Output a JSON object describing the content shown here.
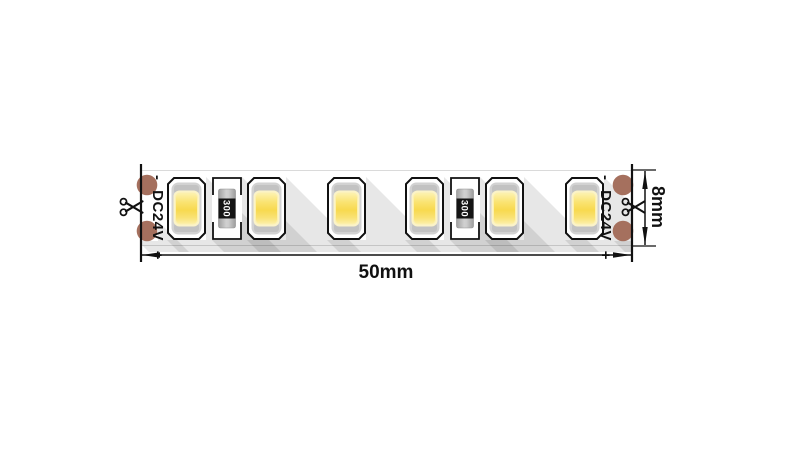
{
  "diagram": {
    "description": "LED strip segment dimension drawing",
    "power_marking": {
      "negative": "-",
      "label": "DC24V",
      "positive": "+"
    },
    "resistor": {
      "value_label": "300"
    },
    "dimensions": {
      "length_label": "50mm",
      "height_label": "8mm"
    },
    "components": {
      "led_count": 6,
      "resistor_count": 2,
      "solder_pad_count": 4,
      "cut_marks": 2
    },
    "colors": {
      "background": "#ffffff",
      "outline": "#111111",
      "solder_pad": "#a5705e",
      "led_phosphor_yellow": "#f8d94f",
      "led_body_gray": "#d2d2d2",
      "resistor_body": "#b5b5b5",
      "resistor_band": "#141414",
      "shadow": "rgba(0,0,0,0.095)"
    }
  }
}
